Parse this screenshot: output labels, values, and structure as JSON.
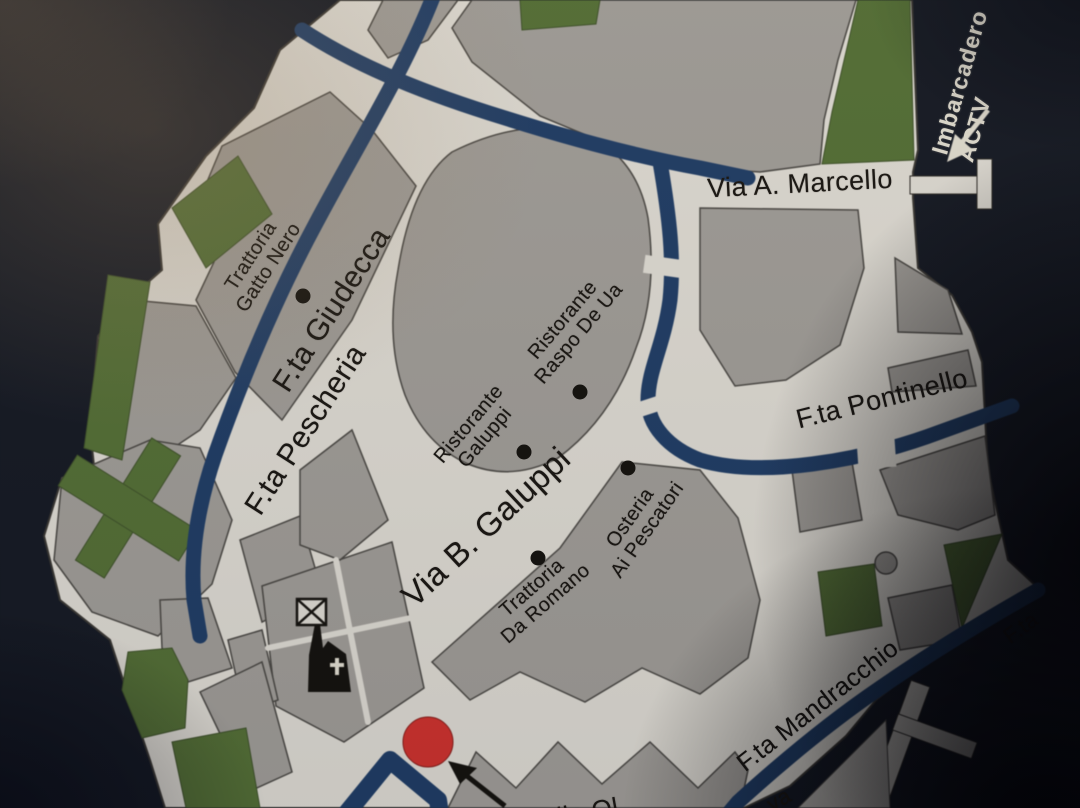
{
  "map": {
    "colors": {
      "water": "#161b26",
      "street": "#e9e6de",
      "building": "#a8a5a0",
      "building_line": "#4e4c48",
      "canal": "#21406b",
      "park": "#587539",
      "marker": "#d93530",
      "label": "#1a1713",
      "light_label": "#ece8db",
      "wedge": "#c8c5bf"
    },
    "landmark": {
      "imbarcadero": {
        "lines": [
          "Imbarcadero",
          "ACTV"
        ],
        "x": 973,
        "y": 86,
        "rot": -74,
        "size": 23
      }
    },
    "street_labels": [
      {
        "id": "via-a-marcello",
        "text": "Via A. Marcello",
        "x": 800,
        "y": 184,
        "rot": -3,
        "size": 27
      },
      {
        "id": "fta-giudecca",
        "text": "F.ta Giudecca",
        "x": 332,
        "y": 310,
        "rot": -57,
        "size": 30
      },
      {
        "id": "fta-pescheria",
        "text": "F.ta Pescheria",
        "x": 306,
        "y": 430,
        "rot": -57,
        "size": 30
      },
      {
        "id": "via-b-galuppi",
        "text": "Via B. Galuppi",
        "x": 486,
        "y": 527,
        "rot": -43,
        "size": 33
      },
      {
        "id": "fta-pontinello",
        "text": "F.ta Pontinello",
        "x": 882,
        "y": 399,
        "rot": -14,
        "size": 27
      },
      {
        "id": "fta-mandracchio",
        "text": "F.ta Mandracchio",
        "x": 818,
        "y": 706,
        "rot": -38,
        "size": 25
      },
      {
        "id": "fragment-fta",
        "text": "F.ta",
        "x": 1021,
        "y": 628,
        "rot": -36,
        "size": 22
      },
      {
        "id": "fragment-va",
        "text": "va",
        "x": 779,
        "y": 800,
        "rot": -30,
        "size": 22
      },
      {
        "id": "fragment-lla-ol",
        "text": "lla Ol",
        "x": 588,
        "y": 812,
        "rot": -10,
        "size": 26
      }
    ],
    "poi_labels": [
      {
        "id": "trattoria-gatto-nero",
        "lines": [
          "Trattoria",
          "Gatto Nero"
        ],
        "x": 260,
        "y": 262,
        "rot": -57,
        "size": 20,
        "dot": {
          "x": 303,
          "y": 296
        }
      },
      {
        "id": "ristorante-galuppi",
        "lines": [
          "Ristorante",
          "Galuppi"
        ],
        "x": 477,
        "y": 431,
        "rot": -50,
        "size": 20,
        "dot": {
          "x": 524,
          "y": 452
        }
      },
      {
        "id": "ristorante-raspo-de-ua",
        "lines": [
          "Ristorante",
          "Raspo De Ua"
        ],
        "x": 571,
        "y": 327,
        "rot": -50,
        "size": 20,
        "dot": {
          "x": 580,
          "y": 392
        }
      },
      {
        "id": "trattoria-da-romano",
        "lines": [
          "Trattoria",
          "Da Romano"
        ],
        "x": 539,
        "y": 596,
        "rot": -41,
        "size": 20,
        "dot": {
          "x": 538,
          "y": 558
        }
      },
      {
        "id": "osteria-ai-pescatori",
        "lines": [
          "Osteria",
          "Ai Pescatori"
        ],
        "x": 639,
        "y": 524,
        "rot": -55,
        "size": 20,
        "dot": {
          "x": 628,
          "y": 468
        }
      }
    ],
    "marker": {
      "x": 428,
      "y": 742,
      "r": 25
    }
  }
}
